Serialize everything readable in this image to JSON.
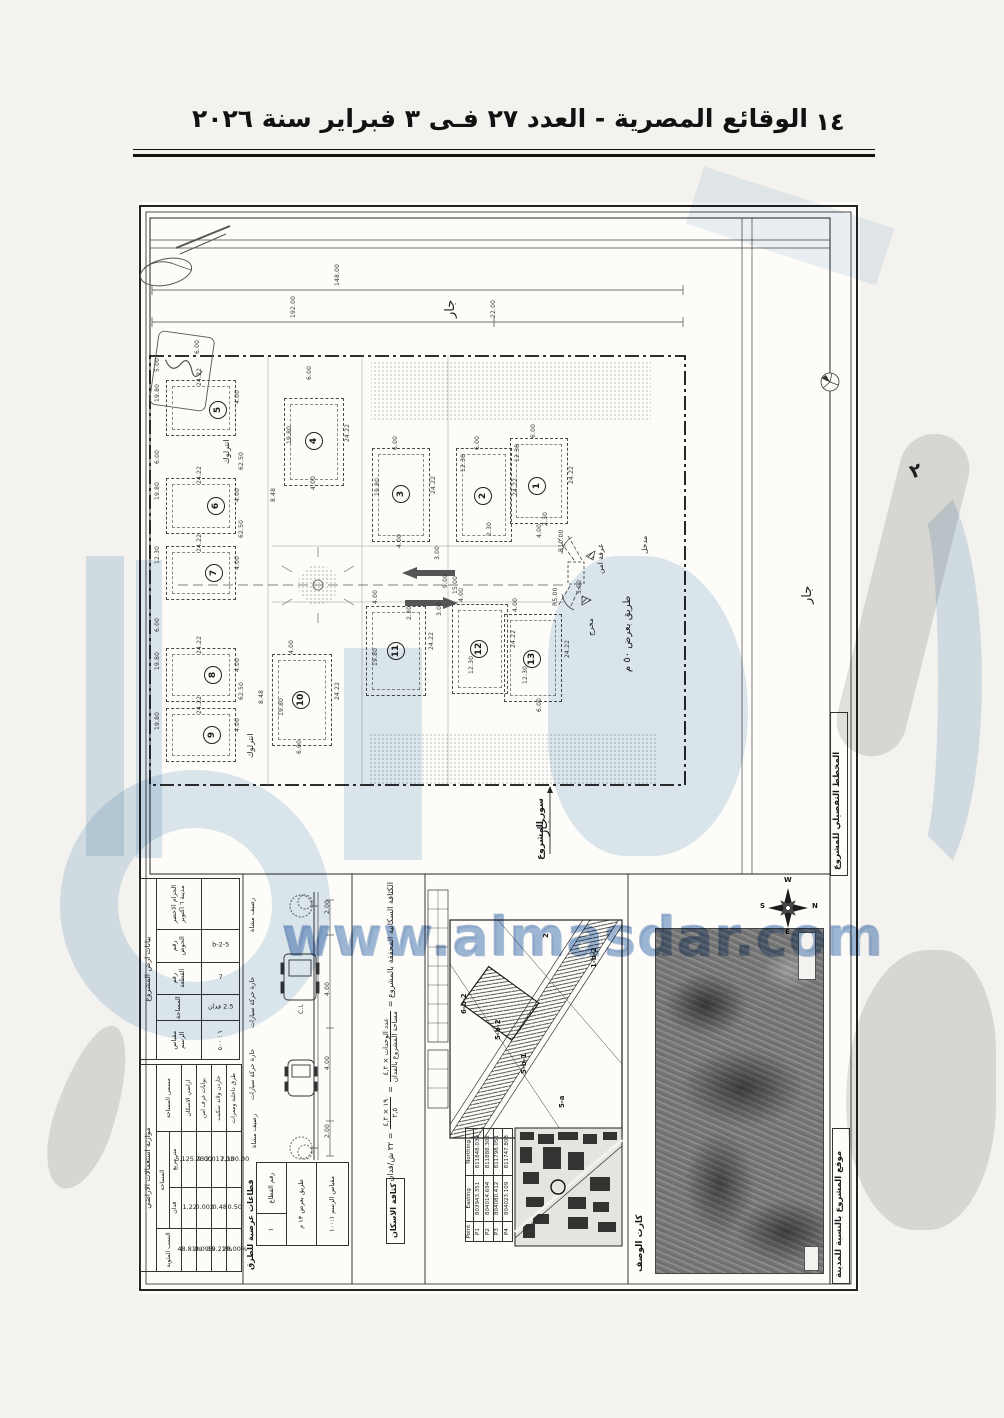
{
  "header": {
    "title": "الوقائع المصرية - العدد ٢٧ فـى ٣ فبراير سنة ٢٠٢٦",
    "page_number": "١٤"
  },
  "watermark": {
    "url": "www.almasdar.com"
  },
  "plan": {
    "labels": {
      "neighbor": "جار",
      "fence": "سور المشروع",
      "road50": "طريق بعرض ٥٠ م",
      "entrance": "مدخل",
      "exit": "مخرج",
      "security_room": "غرفة امن",
      "interlock": "انترلوك",
      "handwritten_note": "٢",
      "detail_plan_title": "المخطط التفصيلي للمشروع",
      "site_location_caption": "موقع المشروع بالنسبة للمدينة",
      "card_label": "كارت الوصف",
      "density_side": "كثافة الاسكان",
      "sections_side": "قطاعات عرضية للطرق",
      "sidewalk": "رصيف مشاة",
      "lane": "حارة حركة سيارات",
      "cl": "C.L"
    },
    "plots": [
      {
        "n": "1",
        "x": 372,
        "y": 236,
        "w": 56,
        "h": 84,
        "cx": 398,
        "cy": 283
      },
      {
        "n": "2",
        "x": 318,
        "y": 246,
        "w": 54,
        "h": 92,
        "cx": 344,
        "cy": 293
      },
      {
        "n": "3",
        "x": 234,
        "y": 246,
        "w": 56,
        "h": 92,
        "cx": 262,
        "cy": 291
      },
      {
        "n": "4",
        "x": 146,
        "y": 196,
        "w": 58,
        "h": 86,
        "cx": 175,
        "cy": 238
      },
      {
        "n": "5",
        "x": 28,
        "y": 178,
        "w": 68,
        "h": 54,
        "cx": 79,
        "cy": 207
      },
      {
        "n": "6",
        "x": 28,
        "y": 276,
        "w": 68,
        "h": 54,
        "cx": 77,
        "cy": 303
      },
      {
        "n": "7",
        "x": 28,
        "y": 344,
        "w": 68,
        "h": 52,
        "cx": 75,
        "cy": 370
      },
      {
        "n": "8",
        "x": 28,
        "y": 446,
        "w": 68,
        "h": 52,
        "cx": 74,
        "cy": 472
      },
      {
        "n": "9",
        "x": 28,
        "y": 506,
        "w": 68,
        "h": 52,
        "cx": 73,
        "cy": 532
      },
      {
        "n": "10",
        "x": 134,
        "y": 452,
        "w": 58,
        "h": 90,
        "cx": 162,
        "cy": 497
      },
      {
        "n": "11",
        "x": 228,
        "y": 404,
        "w": 58,
        "h": 88,
        "cx": 257,
        "cy": 448
      },
      {
        "n": "12",
        "x": 314,
        "y": 402,
        "w": 54,
        "h": 88,
        "cx": 340,
        "cy": 446
      },
      {
        "n": "13",
        "x": 366,
        "y": 412,
        "w": 56,
        "h": 86,
        "cx": 393,
        "cy": 456
      }
    ],
    "dims": [
      {
        "t": "148.00",
        "x": 196,
        "y": 84
      },
      {
        "t": "192.00",
        "x": 152,
        "y": 116
      },
      {
        "t": "22.00",
        "x": 352,
        "y": 116
      },
      {
        "t": "6.00",
        "x": 56,
        "y": 152
      },
      {
        "t": "5.00",
        "x": 16,
        "y": 170
      },
      {
        "t": "24.22",
        "x": 58,
        "y": 184
      },
      {
        "t": "19.80",
        "x": 16,
        "y": 200
      },
      {
        "t": "4.00",
        "x": 96,
        "y": 202
      },
      {
        "t": "6.00",
        "x": 16,
        "y": 262
      },
      {
        "t": "24.22",
        "x": 58,
        "y": 282
      },
      {
        "t": "19.80",
        "x": 16,
        "y": 298
      },
      {
        "t": "4.00",
        "x": 96,
        "y": 300
      },
      {
        "t": "62.50",
        "x": 100,
        "y": 268
      },
      {
        "t": "24.22",
        "x": 58,
        "y": 350
      },
      {
        "t": "12.30",
        "x": 16,
        "y": 362
      },
      {
        "t": "4.00",
        "x": 96,
        "y": 368
      },
      {
        "t": "62.50",
        "x": 100,
        "y": 336
      },
      {
        "t": "6.00",
        "x": 16,
        "y": 430
      },
      {
        "t": "24.22",
        "x": 58,
        "y": 452
      },
      {
        "t": "19.80",
        "x": 16,
        "y": 468
      },
      {
        "t": "4.00",
        "x": 96,
        "y": 470
      },
      {
        "t": "24.22",
        "x": 58,
        "y": 512
      },
      {
        "t": "19.80",
        "x": 16,
        "y": 528
      },
      {
        "t": "4.00",
        "x": 96,
        "y": 530
      },
      {
        "t": "62.50",
        "x": 100,
        "y": 498
      },
      {
        "t": "6.00",
        "x": 168,
        "y": 178
      },
      {
        "t": "24.22",
        "x": 206,
        "y": 240
      },
      {
        "t": "19.80",
        "x": 148,
        "y": 242
      },
      {
        "t": "4.00",
        "x": 172,
        "y": 288
      },
      {
        "t": "8.48",
        "x": 132,
        "y": 300
      },
      {
        "t": "6.00",
        "x": 254,
        "y": 248
      },
      {
        "t": "24.22",
        "x": 292,
        "y": 292
      },
      {
        "t": "19.80",
        "x": 236,
        "y": 294
      },
      {
        "t": "4.00",
        "x": 258,
        "y": 346
      },
      {
        "t": "6.00",
        "x": 336,
        "y": 248
      },
      {
        "t": "24.22",
        "x": 374,
        "y": 294
      },
      {
        "t": "12.30",
        "x": 322,
        "y": 270
      },
      {
        "t": "2.30",
        "x": 348,
        "y": 334
      },
      {
        "t": "6.00",
        "x": 392,
        "y": 236
      },
      {
        "t": "24.22",
        "x": 430,
        "y": 282
      },
      {
        "t": "12.30",
        "x": 376,
        "y": 260
      },
      {
        "t": "2.30",
        "x": 404,
        "y": 324
      },
      {
        "t": "4.00",
        "x": 398,
        "y": 336
      },
      {
        "t": "3.00",
        "x": 296,
        "y": 358
      },
      {
        "t": "9.00",
        "x": 304,
        "y": 386
      },
      {
        "t": "15.00",
        "x": 314,
        "y": 392
      },
      {
        "t": "3.00",
        "x": 298,
        "y": 414
      },
      {
        "t": "4.00",
        "x": 234,
        "y": 402
      },
      {
        "t": "24.22",
        "x": 290,
        "y": 448
      },
      {
        "t": "19.80",
        "x": 234,
        "y": 464
      },
      {
        "t": "2.30",
        "x": 268,
        "y": 418
      },
      {
        "t": "4.00",
        "x": 320,
        "y": 400
      },
      {
        "t": "24.22",
        "x": 372,
        "y": 446
      },
      {
        "t": "12.30",
        "x": 330,
        "y": 472
      },
      {
        "t": "4.00",
        "x": 374,
        "y": 410
      },
      {
        "t": "24.22",
        "x": 426,
        "y": 456
      },
      {
        "t": "12.30",
        "x": 384,
        "y": 482
      },
      {
        "t": "6.00",
        "x": 398,
        "y": 510
      },
      {
        "t": "4.00",
        "x": 150,
        "y": 452
      },
      {
        "t": "24.22",
        "x": 196,
        "y": 498
      },
      {
        "t": "19.80",
        "x": 140,
        "y": 514
      },
      {
        "t": "8.48",
        "x": 120,
        "y": 502
      },
      {
        "t": "6.00",
        "x": 158,
        "y": 552
      },
      {
        "t": "R10.00",
        "x": 420,
        "y": 350
      },
      {
        "t": "R5.00",
        "x": 414,
        "y": 404
      },
      {
        "t": "5.00",
        "x": 438,
        "y": 392
      },
      {
        "t": "2.00",
        "x": 186,
        "y": 712
      },
      {
        "t": "4.00",
        "x": 186,
        "y": 794
      },
      {
        "t": "4.00",
        "x": 186,
        "y": 868
      },
      {
        "t": "2.00",
        "x": 186,
        "y": 936
      },
      {
        "t": "C.L",
        "x": 160,
        "y": 812
      }
    ]
  },
  "panels": {
    "land": {
      "title": "بيانات ارض المشروع",
      "cols": [
        {
          "t": "الحزام الاخضر مدينة ٦ اكتوبر",
          "b": ""
        },
        {
          "t": "رقم الحوض",
          "b": "5-b-2"
        },
        {
          "t": "رقم القطعة",
          "b": "7"
        },
        {
          "t": "المساحة",
          "b": "2.5 فدان"
        },
        {
          "t": "مقياس الرسم",
          "b": "١ : ٥٠٠"
        }
      ]
    },
    "usage": {
      "title": "موازنة استعمالات الاراضي",
      "h_name": "مسمى المساحة",
      "h_area": "المساحة",
      "h_m2": "متر مربع",
      "h_fd": "فدان",
      "h_pct": "النسب المئوية",
      "rows": [
        {
          "name": "اراضي الاسكان",
          "m2": "5,125.23",
          "fd": "1.22",
          "pct": "48.81%"
        },
        {
          "name": "بوابات غرف امن",
          "m2": "9.00",
          "fd": "0.002",
          "pct": "0.09%"
        },
        {
          "name": "جاردن ولاند سكيب",
          "m2": "2,017.03",
          "fd": "0.48",
          "pct": "19.21%"
        },
        {
          "name": "طرق داخلية وممرات",
          "m2": "2,100.00",
          "fd": "0.50",
          "pct": "20.00%"
        }
      ]
    },
    "density": {
      "lead": "الكثافة السكانية المحققة بالمشروع =",
      "num": "عدد الوحدات × ٤,٢",
      "den": "مساحة المشروع بالفدان",
      "num2": "١٩ × ٤,٢",
      "den2": "٢,٥",
      "result": "= ٣٢ ش/فدان"
    },
    "section_table": {
      "c1l": "رقم القطاع",
      "c1v": "١",
      "c2": "طريق بعرض ١٣ م",
      "c3": "مقياس الرسم ١٠٠:١"
    },
    "coords": {
      "headers": [
        "Point",
        "Easting",
        "Northing"
      ],
      "rows": [
        [
          "P1",
          "803943.351",
          "811848.039"
        ],
        [
          "P2",
          "804014.694",
          "811888.302"
        ],
        [
          "P3",
          "804080.412",
          "811798.051"
        ],
        [
          "P4",
          "804023.109",
          "811747.808"
        ]
      ]
    },
    "keymap": {
      "labels": [
        {
          "t": "2",
          "x": 404,
          "y": 736
        },
        {
          "t": "1-b-2",
          "x": 452,
          "y": 766
        },
        {
          "t": "6-b-2",
          "x": 322,
          "y": 812
        },
        {
          "t": "5-b-2",
          "x": 356,
          "y": 838
        },
        {
          "t": "5-b-1",
          "x": 382,
          "y": 872
        },
        {
          "t": "5-a",
          "x": 420,
          "y": 906
        }
      ]
    },
    "compass": {
      "w": "W",
      "n": "N",
      "s": "S",
      "e": "E"
    }
  }
}
